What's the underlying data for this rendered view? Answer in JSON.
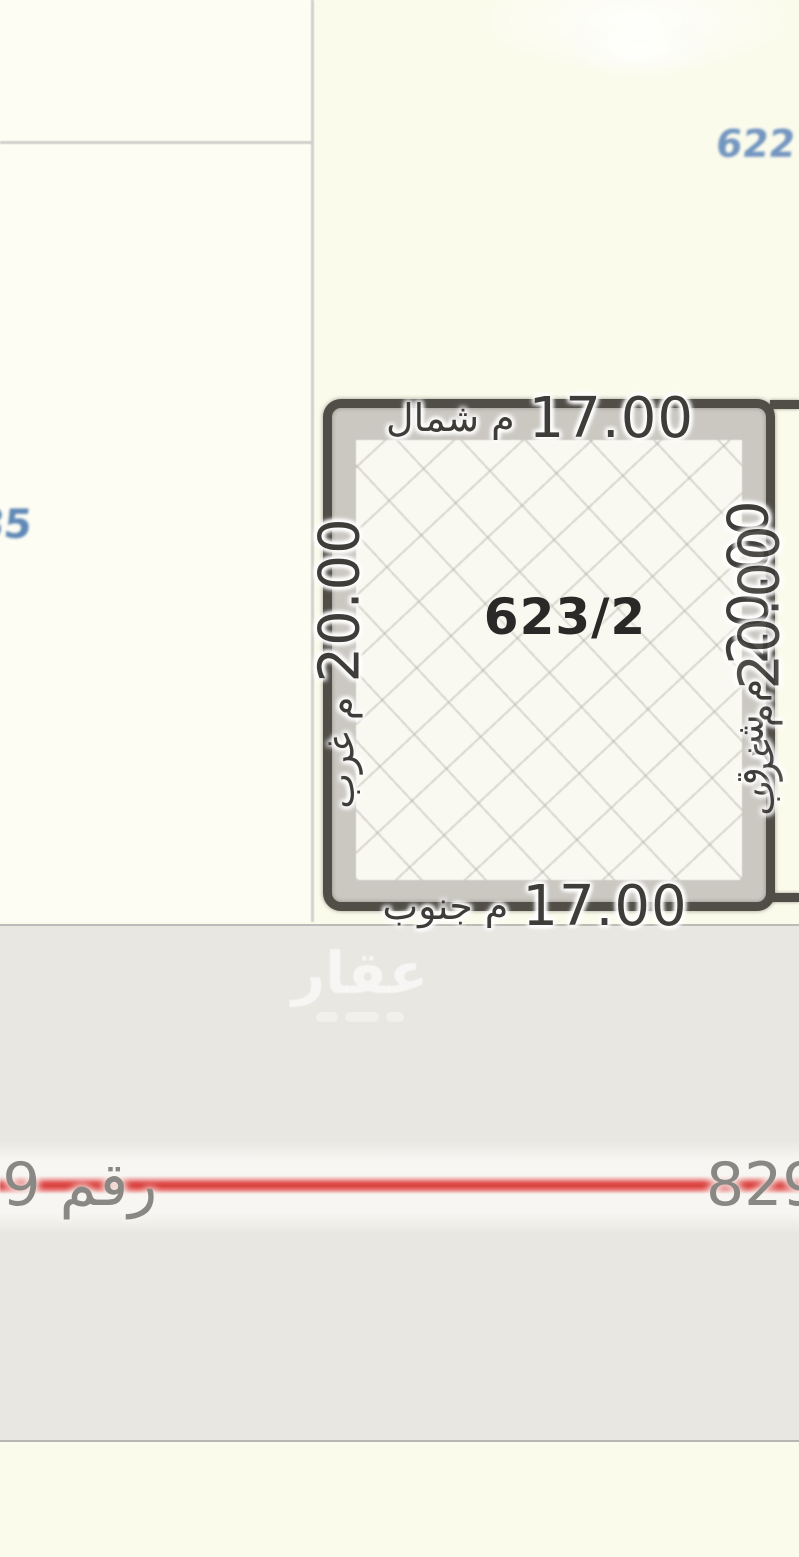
{
  "map": {
    "watermark": {
      "brand": "عقار"
    },
    "street": {
      "label": "رقم 829"
    },
    "parcel": {
      "number": "623/2",
      "north": {
        "value": "17.00",
        "word": "م شمال"
      },
      "south": {
        "value": "17.00",
        "word": "م جنوب"
      },
      "west": {
        "value": "20.00",
        "word": "م غرب"
      },
      "east": {
        "value": "20.00",
        "word": "م شرق"
      },
      "east_overlap": {
        "value": "20.00",
        "word": "م غرب"
      }
    },
    "neighbors": {
      "east_parcel_number": "622",
      "west_edge_partial_number": "85"
    },
    "colors": {
      "background": "#fbfbec",
      "road_band": "#e9e7e2",
      "street_line_red": "#d83f3c",
      "parcel_border": "#514e48",
      "parcel_fill": "#faf9f1",
      "dimension_text": "#3f3d39",
      "street_text": "#8a8884",
      "blue_label": "#7396c0"
    }
  }
}
